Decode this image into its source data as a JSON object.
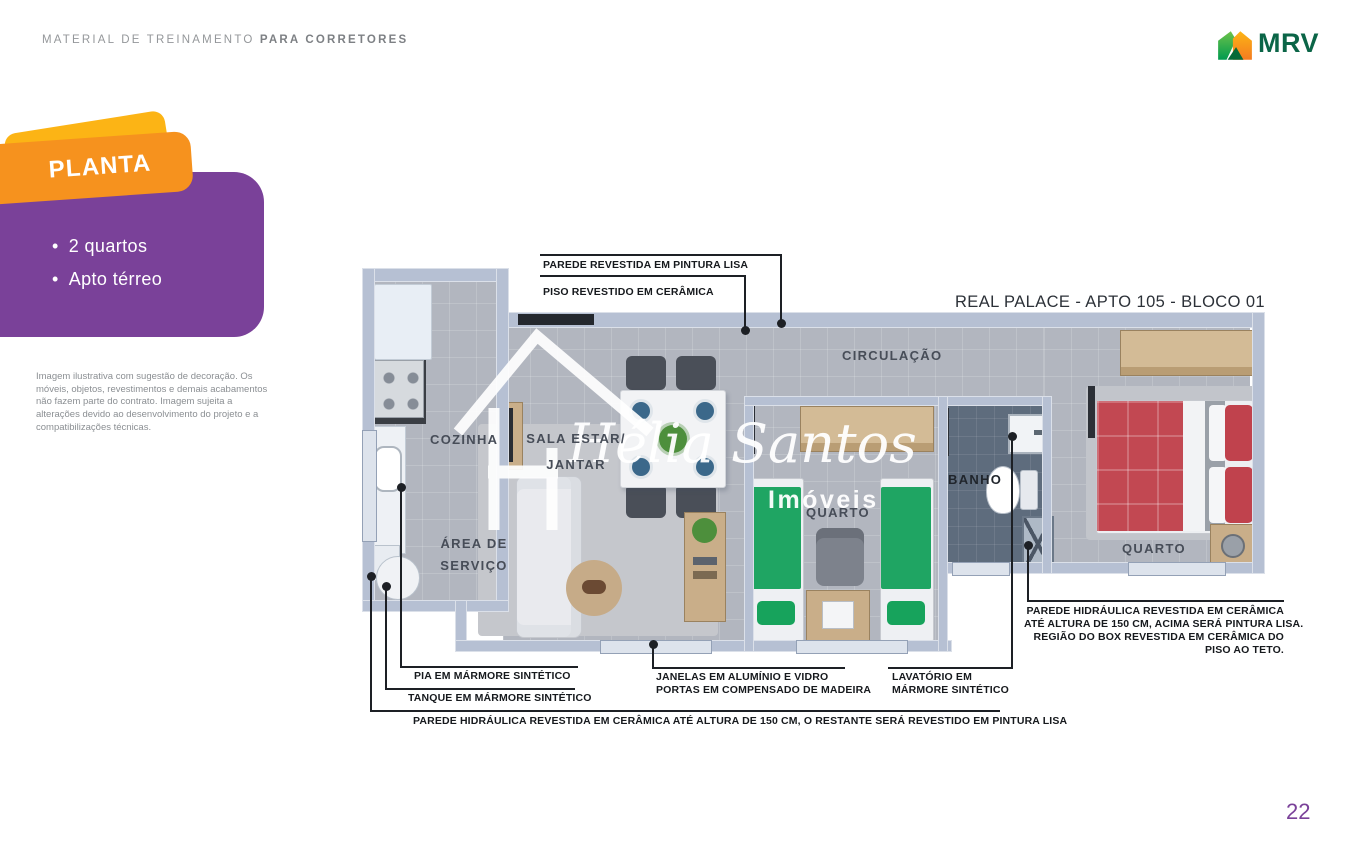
{
  "header": {
    "eyebrow_regular": "MATERIAL DE TREINAMENTO ",
    "eyebrow_bold": "PARA CORRETORES",
    "logo_text": "MRV"
  },
  "side_panel": {
    "badge": "PLANTA",
    "bullet_char": "•",
    "bullets": [
      "2 quartos",
      "Apto térreo"
    ],
    "disclaimer": "Imagem ilustrativa com sugestão de decoração. Os móveis, objetos, revestimentos e demais acabamentos não fazem parte do contrato. Imagem sujeita a alterações devido ao desenvolvimento do projeto e a compatibilizações técnicas."
  },
  "plan": {
    "title": "REAL PALACE - APTO 105 - BLOCO 01",
    "rooms": {
      "cozinha": "COZINHA",
      "area_servico_l1": "ÁREA DE",
      "area_servico_l2": "SERVIÇO",
      "sala_l1": "SALA ESTAR/",
      "sala_l2": "JANTAR",
      "circulacao": "CIRCULAÇÃO",
      "quarto": "QUARTO",
      "banho": "BANHO"
    },
    "annotations": {
      "parede_pintura": "PAREDE REVESTIDA EM PINTURA LISA",
      "piso_ceramica": "PISO REVESTIDO EM CERÂMICA",
      "hidraulica_right": [
        "PAREDE HIDRÁULICA REVESTIDA EM CERÂMICA",
        "ATÉ ALTURA DE 150 CM, ACIMA SERÁ PINTURA LISA.",
        "REGIÃO  DO BOX REVESTIDA EM CERÂMICA DO",
        "PISO AO TETO."
      ],
      "pia": "PIA EM MÁRMORE SINTÉTICO",
      "tanque": "TANQUE EM MÁRMORE SINTÉTICO",
      "janelas_l1": "JANELAS EM ALUMÍNIO E VIDRO",
      "janelas_l2": "PORTAS EM COMPENSADO DE MADEIRA",
      "lavatorio_l1": "LAVATÓRIO EM",
      "lavatorio_l2": "MÁRMORE SINTÉTICO",
      "hidraulica_bottom": "PAREDE HIDRÁULICA REVESTIDA EM CERÂMICA ATÉ ALTURA DE 150 CM, O RESTANTE SERÁ REVESTIDO EM PINTURA LISA"
    },
    "watermark": {
      "name": "Hélia Santos",
      "subtitle": "Imóveis"
    }
  },
  "page_number": "22",
  "colors": {
    "purple": "#7A4199",
    "orange": "#F6921E",
    "yellow": "#FCB415",
    "mrv_green": "#0B6547",
    "annotation_ink": "#1d2025",
    "wall": "#b6c0d3",
    "floor": "#b2b6bf",
    "bath_floor": "#5e6c7d",
    "bed_red": "#C24852",
    "bed_green": "#1FA563",
    "wood": "#C9AE89"
  }
}
